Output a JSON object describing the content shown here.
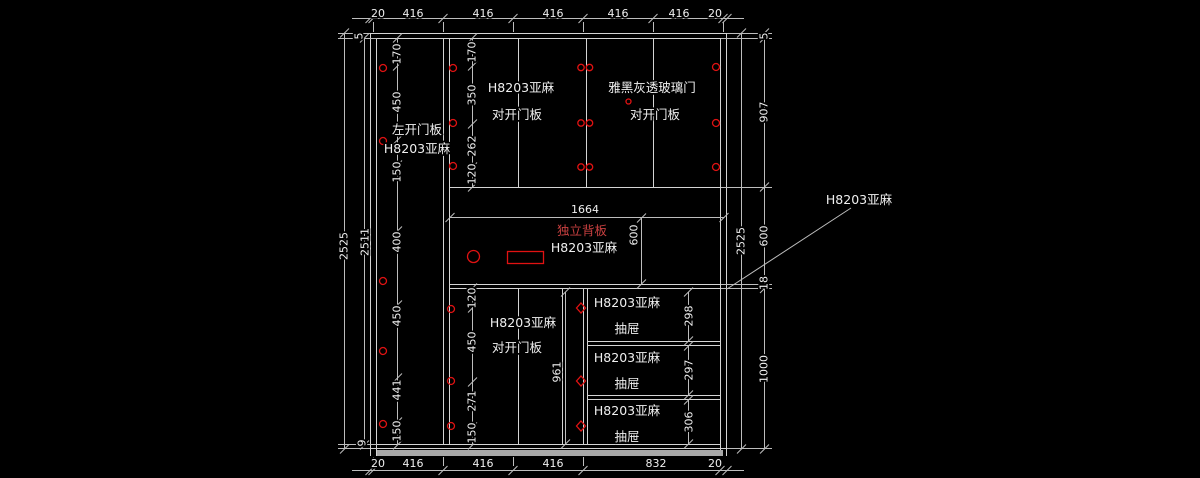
{
  "drawing_title": "cabinet-elevation-cad-drawing",
  "colors": {
    "background": "#000000",
    "structure_line": "#d4d4d4",
    "dimension_line": "#bdbdbd",
    "text": "#f0f0f0",
    "red_mark": "#e01212",
    "red_text": "#c84040",
    "kick_strip": "#a8a8a8"
  },
  "dimensions": {
    "top_row": [
      "20",
      "416",
      "416",
      "416",
      "416",
      "416",
      "20"
    ],
    "bottom_row": [
      "20",
      "416",
      "416",
      "416",
      "832",
      "20"
    ],
    "left": {
      "overall": "2525",
      "inner": "2511",
      "top_gap": "5",
      "bottom_gap": "9",
      "hinge_chain": [
        "170",
        "450",
        "150",
        "400",
        "450",
        "441",
        "150"
      ]
    },
    "right": {
      "overall": "2525",
      "chain": [
        "5",
        "907",
        "600",
        "18",
        "1000"
      ]
    },
    "upper_door_chain": [
      "170",
      "350",
      "262",
      "120"
    ],
    "lower_door_chain": [
      "120",
      "450",
      "271",
      "150"
    ],
    "back_panel": {
      "width": "1664",
      "height": "600"
    },
    "lower_door_height": "961",
    "drawer_heights": [
      "298",
      "297",
      "306"
    ]
  },
  "panels": {
    "left_door": {
      "line1": "左开门板",
      "line2": "H8203亚麻"
    },
    "upper_middle_door": {
      "line1": "H8203亚麻",
      "line2": "对开门板"
    },
    "glass_door": {
      "line1": "雅黑灰透玻璃门",
      "line2": "对开门板"
    },
    "back_panel": {
      "red_label": "独立背板",
      "material": "H8203亚麻"
    },
    "lower_middle_door": {
      "line1": "H8203亚麻",
      "line2": "对开门板"
    },
    "drawers": [
      {
        "material": "H8203亚麻",
        "label": "抽屉"
      },
      {
        "material": "H8203亚麻",
        "label": "抽屉"
      },
      {
        "material": "H8203亚麻",
        "label": "抽屉"
      }
    ],
    "leader_note": "H8203亚麻"
  }
}
